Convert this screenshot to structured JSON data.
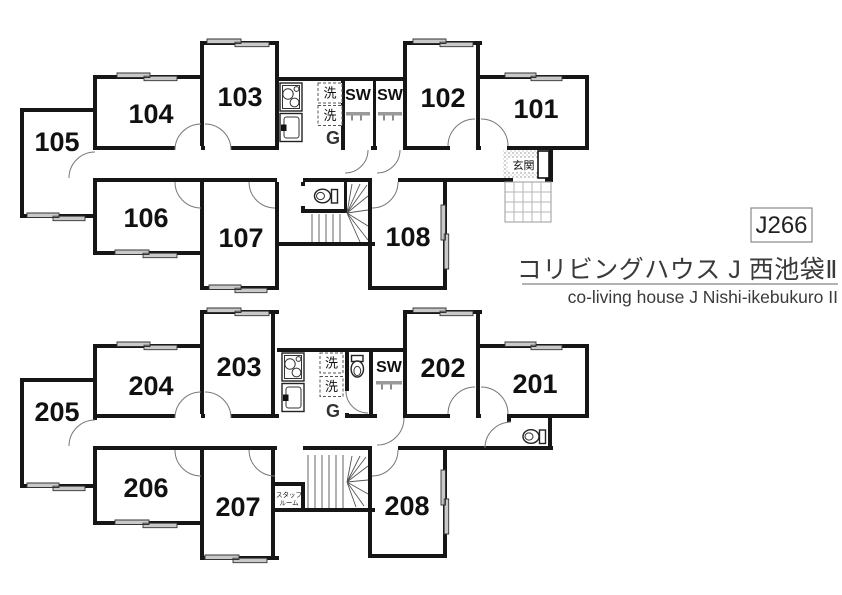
{
  "plan_code": "J266",
  "title": {
    "ja": "コリビングハウス J 西池袋Ⅱ",
    "en": "co-living house J Nishi-ikebukuro II"
  },
  "colors": {
    "wall": "#161616",
    "window_gray": "#c9c9c9",
    "title_text": "#3a3a3a"
  },
  "floor1": {
    "rooms": {
      "r101": "101",
      "r102": "102",
      "r103": "103",
      "r104": "104",
      "r105": "105",
      "r106": "106",
      "r107": "107",
      "r108": "108"
    },
    "labels": {
      "sw1": "SW",
      "sw2": "SW",
      "washer1": "洗",
      "washer2": "洗",
      "gas": "G",
      "entrance": "玄関"
    }
  },
  "floor2": {
    "rooms": {
      "r201": "201",
      "r202": "202",
      "r203": "203",
      "r204": "204",
      "r205": "205",
      "r206": "206",
      "r207": "207",
      "r208": "208"
    },
    "labels": {
      "sw": "SW",
      "washer1": "洗",
      "washer2": "洗",
      "gas": "G",
      "staff_line1": "スタッフ",
      "staff_line2": "ルーム"
    }
  }
}
